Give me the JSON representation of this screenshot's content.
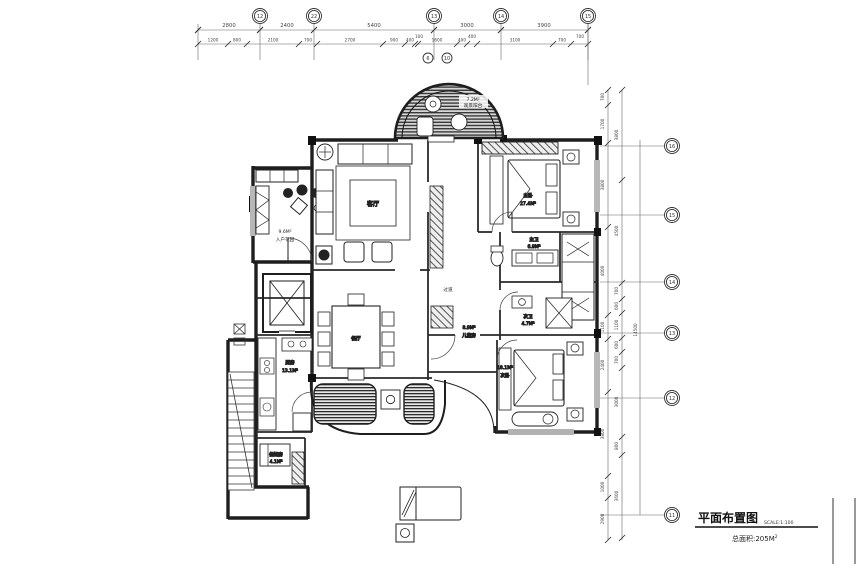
{
  "title_block": {
    "title": "平面布置图",
    "scale_note": "SCALE:1:100",
    "area_prefix": "总面积:205M",
    "area_sup": "2"
  },
  "rooms": {
    "balcony_top": {
      "area": "7.2M²",
      "label": "观景阳台"
    },
    "living": {
      "label": "客厅"
    },
    "entry_garden": {
      "area": "9.6M²",
      "label": "入户花园"
    },
    "master_bedroom": {
      "label": "主卧",
      "area": "27.4M²"
    },
    "master_bath": {
      "label": "主卫",
      "area": "6.9M²"
    },
    "second_bath": {
      "label": "次卫",
      "area": "4.7M²"
    },
    "corridor": {
      "label": "过道"
    },
    "kids_room": {
      "area": "8.9M²",
      "label": "儿童房"
    },
    "second_bedroom": {
      "area": "18.1M²",
      "label": "次卧"
    },
    "dining": {
      "label": "餐厅"
    },
    "kitchen": {
      "label": "厨房",
      "area": "13.1M²"
    },
    "maid_room": {
      "label": "保姆房",
      "area": "4.1M²"
    }
  },
  "dims": {
    "top_row1": [
      "2800",
      "2400",
      "5400",
      "3000",
      "3900"
    ],
    "top_row2": [
      "1200",
      "800",
      "2100",
      "700",
      "2700",
      "900",
      "400",
      "100",
      "1600",
      "400",
      "400",
      "3100",
      "700",
      "700"
    ],
    "right_inner": [
      "700",
      "1700",
      "3800",
      "4000",
      "1100",
      "2400",
      "3800",
      "1000",
      "2900"
    ],
    "right_outer": [
      "3800",
      "4500",
      "700",
      "600",
      "1100",
      "600",
      "700",
      "3000",
      "800",
      "3600"
    ],
    "right_total": "14500"
  },
  "grid": {
    "top": [
      "12",
      "22",
      "13",
      "14",
      "15"
    ],
    "top_sub": [
      "6",
      "10"
    ],
    "right": [
      "16",
      "15",
      "14",
      "13",
      "12",
      "11"
    ]
  },
  "colors": {
    "line": "#2a2a2a",
    "dim_line": "#666",
    "hatch_bg": "#cfcfcf"
  }
}
